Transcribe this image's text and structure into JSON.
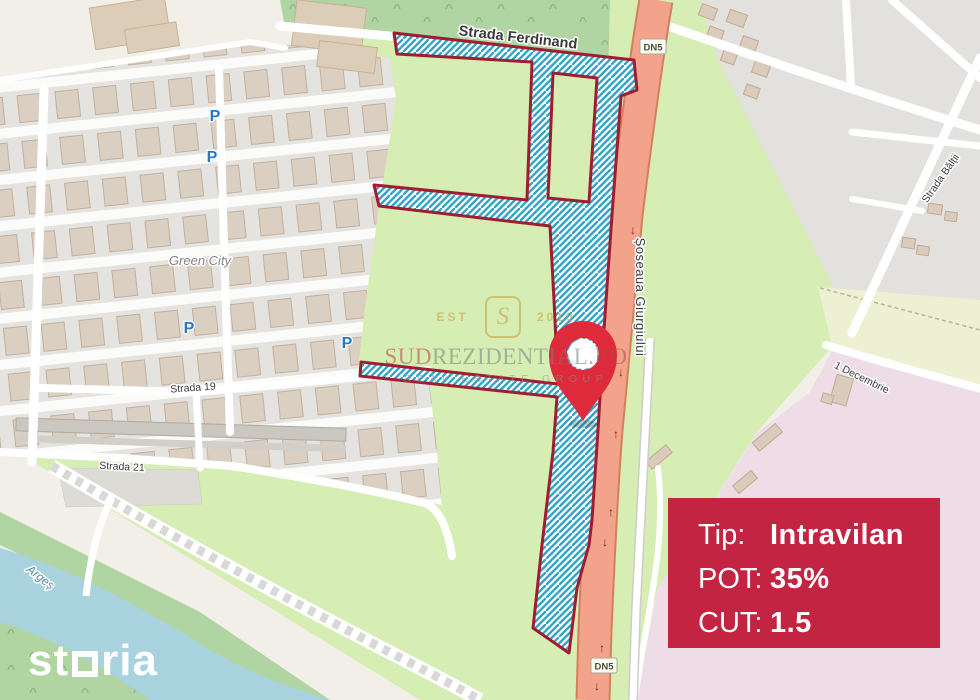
{
  "map": {
    "labels": {
      "ferdinand": "Strada Ferdinand",
      "giurgiului": "Șoseaua Giurgiului",
      "baltii": "Strada Bălții",
      "decembrie": "1 Decembrie",
      "green_city": "Green City",
      "strada19": "Strada 19",
      "strada21": "Strada 21",
      "river": "Argeș"
    },
    "badges": {
      "dn5": "DN5"
    },
    "icons": {
      "parking": "P",
      "arrow_up": "↑",
      "arrow_down": "↓"
    },
    "colors": {
      "road_primary": "#f3a28b",
      "hatch_line": "#2fa3c7",
      "plot_border": "#a01d30",
      "pin": "#de2a3a",
      "card_bg": "#c32442",
      "water": "#a8d2de",
      "grass": "#d6edb4",
      "pink_zone": "#eedce6"
    }
  },
  "watermark": {
    "est": "EST",
    "monogram": "S",
    "year": "2010",
    "brand_sud": "SUD",
    "brand_mid": "REZIDENTIAL",
    "brand_ro": ".RO",
    "tagline": "REAL ESTATE GROUP"
  },
  "logo": {
    "part1": "st",
    "part2": "ria"
  },
  "card": {
    "rows": [
      {
        "label": "Tip:",
        "value": "Intravilan"
      },
      {
        "label": "POT:",
        "value": "35%"
      },
      {
        "label": "CUT:",
        "value": "1.5"
      }
    ]
  }
}
